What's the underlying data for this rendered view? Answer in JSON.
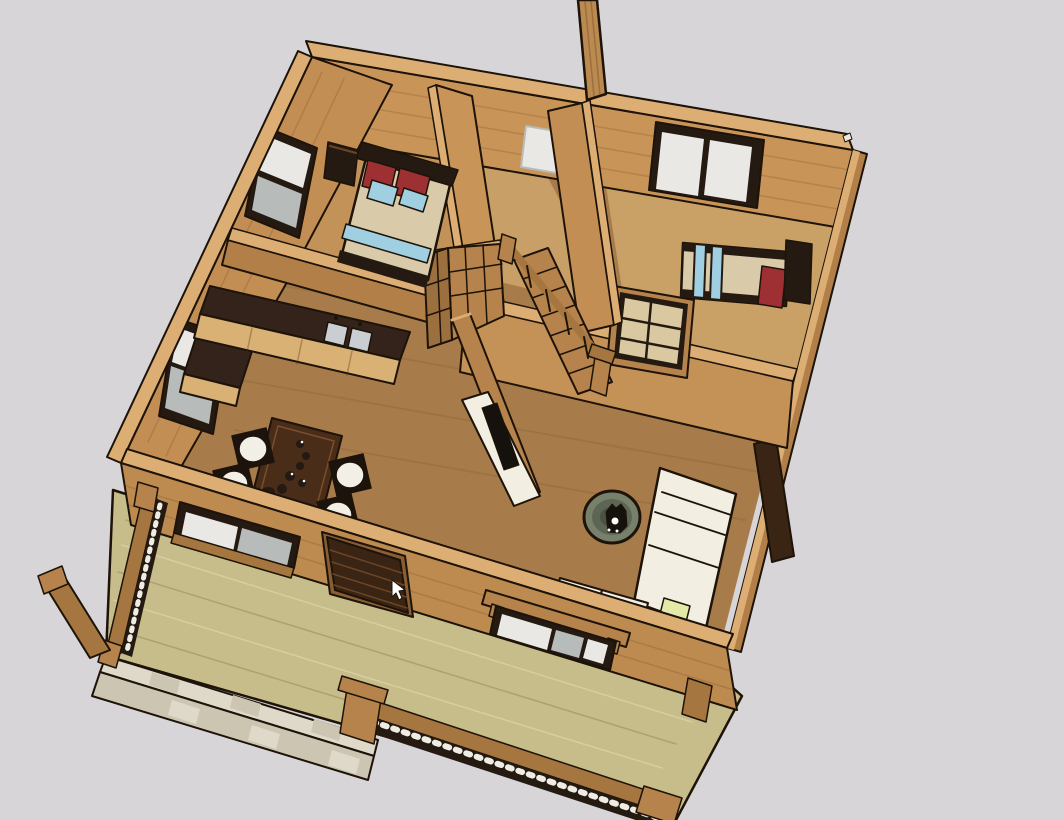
{
  "meta": {
    "description": "3D SketchUp-style cutaway model of a small one-storey cabin floor plan viewed from above, showing two bedrooms, bathroom, kitchen, living area, staircase and a front wooden deck with railing",
    "scene_objects": [
      "deck",
      "stone-walkway",
      "house-floor",
      "bedroom-1",
      "bathroom",
      "bedroom-2",
      "living-room",
      "kitchen-counter",
      "kitchen-sink",
      "dining-table",
      "dining-chairs",
      "double-bed",
      "single-bed",
      "nightstand",
      "staircase",
      "corner-hutch",
      "media-wall",
      "media-console",
      "tv",
      "sofa",
      "ottoman",
      "cat",
      "front-door",
      "windows",
      "deck-railing",
      "chimney-post",
      "mouse-cursor"
    ]
  },
  "viewport": {
    "width": 1064,
    "height": 820
  },
  "palette": {
    "bg": "#d7d5d7",
    "outline": "#1d1309",
    "wallTop": "#dcae74",
    "wallFaceNE": "#c89458",
    "wallFaceWest": "#c38e54",
    "wallFaceFront": "#bd8a50",
    "wallFaceShade": "#b27f48",
    "wallFaceDiv": "#c49156",
    "floorLiving": "#a87c4a",
    "floorBed1": "#c29259",
    "floorBath": "#c89f66",
    "floorBed2": "#c9a066",
    "deck": "#c6bd8a",
    "stoneLight": "#ded9c9",
    "stoneDark": "#ccc5b2",
    "counterTop": "#34231a",
    "cabinet": "#d9b175",
    "steel": "#c9ced2",
    "bedBlanket": "#d9caaa",
    "pillowRed": "#9e3033",
    "pillowBlue": "#9fcfe0",
    "headboard": "#241a12",
    "sofa": "#f2eee1",
    "yellowCushion": "#e3eaa8",
    "ottoman": "#76806b",
    "cat": "#15120c",
    "tableWood": "#4a2d18",
    "tableRim": "#7a4e2a",
    "chairFrame": "#1c130c",
    "cushion": "#f2efe6",
    "doorBrown": "#3a2413",
    "doorSlat": "#6b4526",
    "doorTrim": "#8a5e34",
    "railWood": "#a5763f",
    "postWood": "#b5834b",
    "balusterDark": "#241a12",
    "balusterWhite": "#efece4",
    "glassLight": "#e9e8e4",
    "glassGray": "#b7bbb9",
    "frameDark": "#241a12",
    "hallPane": "#d9c8a0",
    "tv": "#15110c",
    "console": "#f2eee1",
    "chimney": "#bb8a50",
    "hutch": "#b5834b",
    "hutchShade": "#9c6f3e",
    "white": "#ffffff",
    "plankShade": "rgba(92,52,20,0.18)",
    "floorStreak": "rgba(70,40,15,0.10)",
    "deckStreakD": "rgba(110,100,55,0.30)",
    "deckStreakL": "rgba(255,250,225,0.28)",
    "seamShade": "rgba(90,50,20,0.35)",
    "chimneySeam": "rgba(60,30,10,0.25)",
    "ottomanTex": "rgba(20,25,15,0.25)"
  }
}
